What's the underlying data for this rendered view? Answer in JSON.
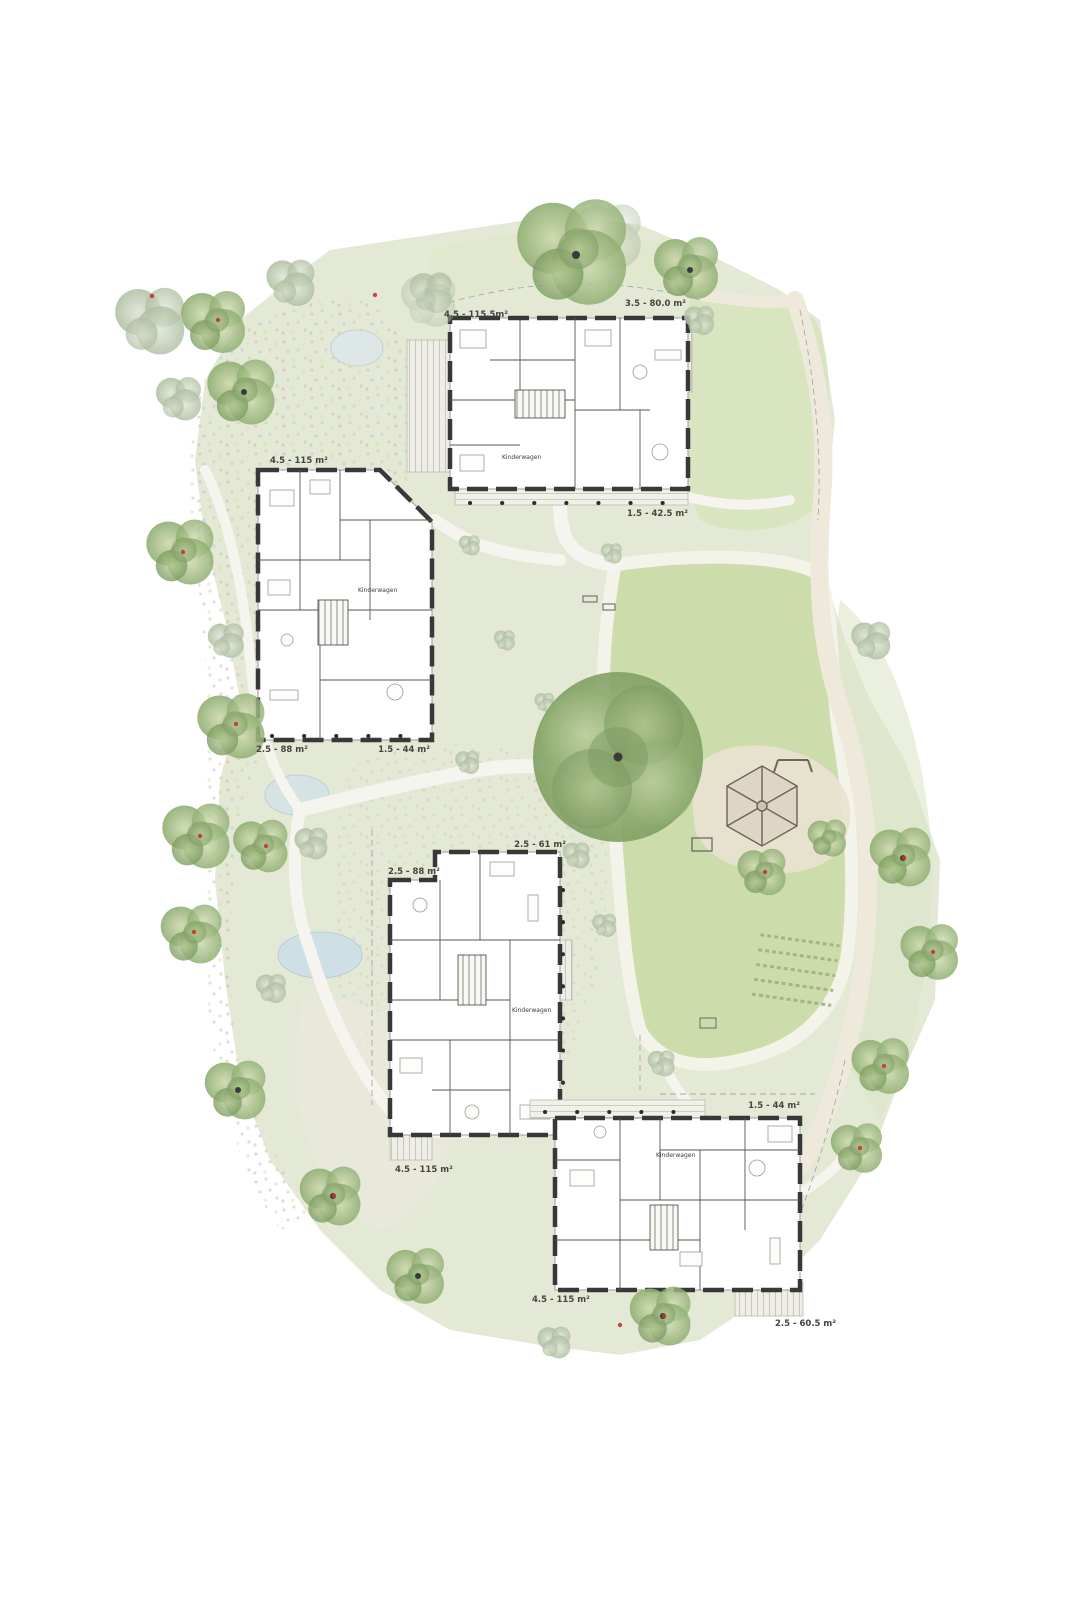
{
  "palette": {
    "ground": "#e4e9d6",
    "lawn": "#cddcab",
    "tree_green": "#8fae72",
    "tree_gray": "#adbd9f",
    "pond": "#cfdfe6",
    "walkway": "#f5f4ee",
    "walkway_beige": "#efe9db",
    "wall": "#383838",
    "tree_marker_red": "#c0392f"
  },
  "buildings": {
    "north": {
      "labels": {
        "top_left": "4.5 - 115.5m²",
        "top_right": "3.5 - 80.0 m²",
        "bottom_right": "1.5 - 42.5 m²"
      },
      "room_label": "Kinderwagen"
    },
    "west": {
      "labels": {
        "top_left": "4.5 - 115 m²",
        "bottom_left": "2.5 - 88 m²",
        "bottom_right": "1.5 - 44 m²"
      },
      "room_label": "Kinderwagen"
    },
    "center": {
      "labels": {
        "top_left": "2.5 - 88 m²",
        "top_right": "2.5 - 61 m²",
        "bottom_left": "4.5 - 115 m²"
      },
      "room_label": "Kinderwagen"
    },
    "southeast": {
      "labels": {
        "top_right": "1.5 - 44 m²",
        "bottom_left": "4.5 - 115 m²",
        "bottom_right": "2.5 - 60.5 m²"
      },
      "room_label": "Kinderwagen"
    }
  }
}
